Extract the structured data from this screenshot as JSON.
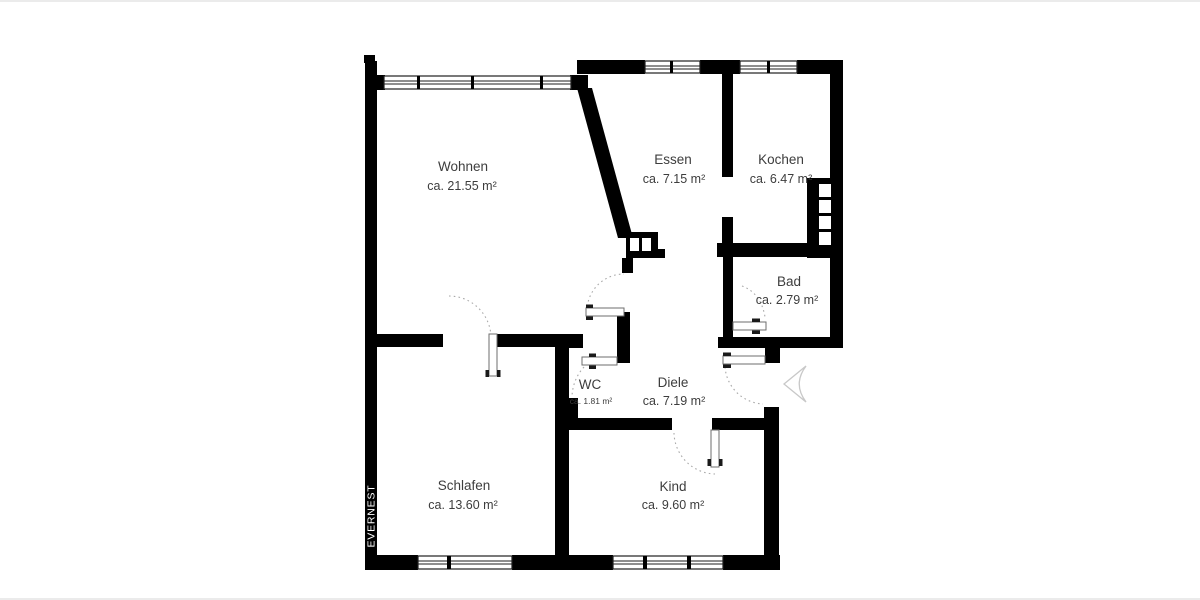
{
  "colors": {
    "background": "#ffffff",
    "walls": "#000000",
    "text": "#3d3d3d",
    "door_arc": "#a9a9a9",
    "entrance_arrow": "#c8c8c8",
    "image_border": "#ebebeb"
  },
  "brand": {
    "name": "EVERNEST"
  },
  "rooms": [
    {
      "id": "wohnen",
      "name": "Wohnen",
      "area": "ca. 21.55 m²"
    },
    {
      "id": "essen",
      "name": "Essen",
      "area": "ca. 7.15 m²"
    },
    {
      "id": "kochen",
      "name": "Kochen",
      "area": "ca. 6.47 m²"
    },
    {
      "id": "bad",
      "name": "Bad",
      "area": "ca. 2.79 m²"
    },
    {
      "id": "wc",
      "name": "WC",
      "area": "ca. 1.81 m²"
    },
    {
      "id": "diele",
      "name": "Diele",
      "area": "ca. 7.19 m²"
    },
    {
      "id": "schlafen",
      "name": "Schlafen",
      "area": "ca. 13.60 m²"
    },
    {
      "id": "kind",
      "name": "Kind",
      "area": "ca. 9.60 m²"
    }
  ],
  "icons": {
    "entrance_arrow": "left-pointing-arrowhead"
  }
}
